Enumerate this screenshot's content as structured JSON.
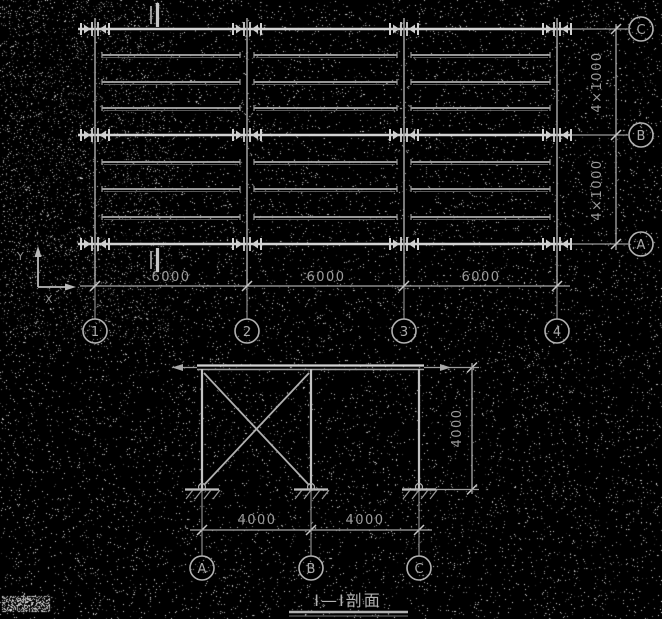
{
  "app": {
    "type": "cad-structural-drawing"
  },
  "colors": {
    "background": "#000000",
    "line": "#b2b2b2",
    "bright_line": "#d4d4d4",
    "dim_text": "#9c9c9c"
  },
  "plan": {
    "column_labels": [
      "1",
      "2",
      "3",
      "4"
    ],
    "row_labels": [
      "C",
      "B",
      "A"
    ],
    "bay_dims": [
      "6000",
      "6000",
      "6000"
    ],
    "row_dims": [
      "4×1000",
      "4×1000"
    ]
  },
  "section": {
    "caption": "Ⅰ—Ⅰ剖面",
    "column_labels": [
      "A",
      "B",
      "C"
    ],
    "bay_dims": [
      "4000",
      "4000"
    ],
    "height_dim": "4000"
  },
  "axis": {
    "x_label": "X",
    "y_label": "Y"
  }
}
